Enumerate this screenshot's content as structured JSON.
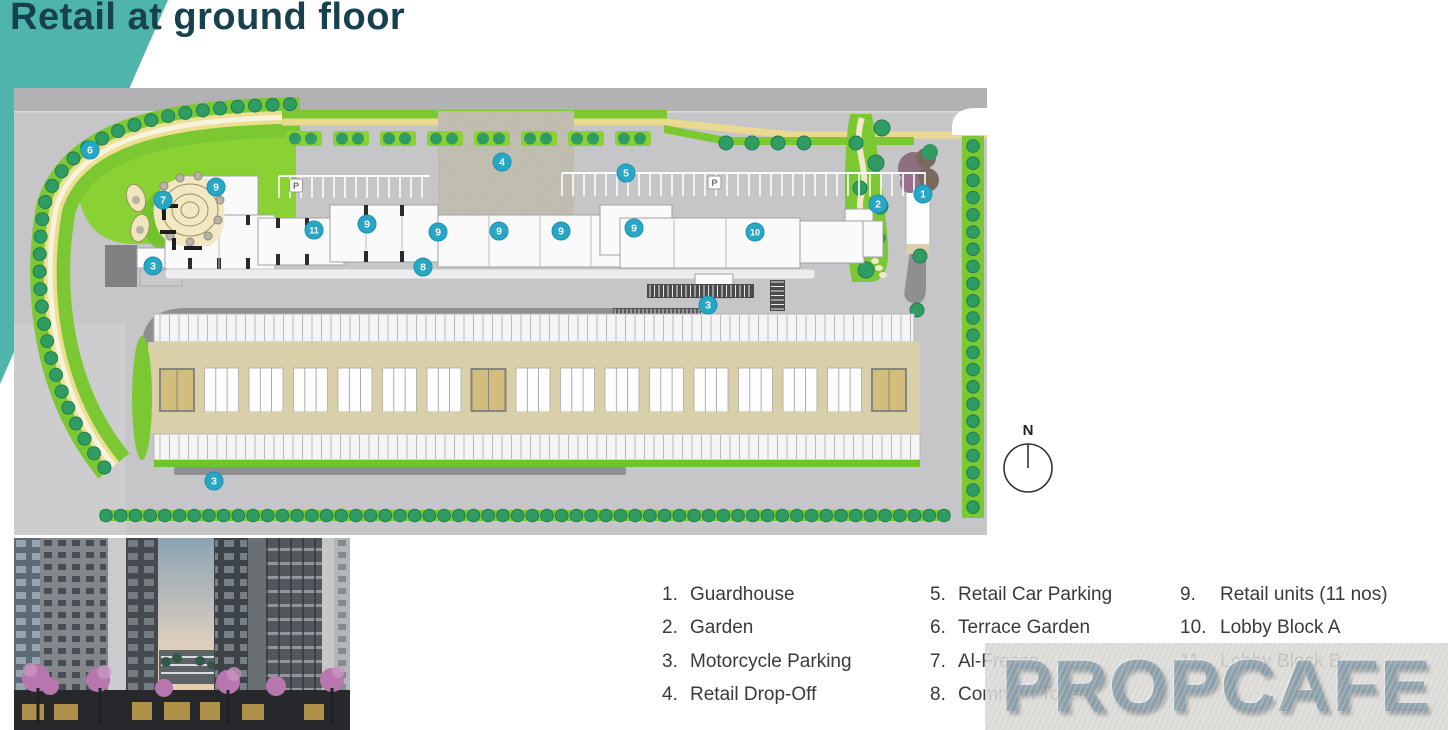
{
  "header": {
    "title": "Retail at ground floor"
  },
  "plan": {
    "compass_label": "N",
    "parking_sign": "P",
    "marker_color": "#29a6c6",
    "markers": [
      {
        "n": "1",
        "x": 909,
        "y": 106
      },
      {
        "n": "2",
        "x": 864,
        "y": 116
      },
      {
        "n": "3",
        "x": 139,
        "y": 178
      },
      {
        "n": "3",
        "x": 694,
        "y": 217
      },
      {
        "n": "3",
        "x": 200,
        "y": 393
      },
      {
        "n": "4",
        "x": 488,
        "y": 74
      },
      {
        "n": "5",
        "x": 612,
        "y": 85
      },
      {
        "n": "6",
        "x": 76,
        "y": 62
      },
      {
        "n": "7",
        "x": 149,
        "y": 112
      },
      {
        "n": "8",
        "x": 409,
        "y": 179
      },
      {
        "n": "9",
        "x": 202,
        "y": 99
      },
      {
        "n": "9",
        "x": 353,
        "y": 136
      },
      {
        "n": "9",
        "x": 424,
        "y": 144
      },
      {
        "n": "9",
        "x": 485,
        "y": 143
      },
      {
        "n": "9",
        "x": 547,
        "y": 143
      },
      {
        "n": "9",
        "x": 620,
        "y": 140
      },
      {
        "n": "10",
        "x": 741,
        "y": 144
      },
      {
        "n": "11",
        "x": 300,
        "y": 142
      }
    ]
  },
  "legend": {
    "items": [
      {
        "num": "1.",
        "label": "Guardhouse"
      },
      {
        "num": "2.",
        "label": "Garden"
      },
      {
        "num": "3.",
        "label": "Motorcycle Parking"
      },
      {
        "num": "4.",
        "label": "Retail Drop-Off"
      },
      {
        "num": "5.",
        "label": "Retail Car Parking"
      },
      {
        "num": "6.",
        "label": "Terrace Garden"
      },
      {
        "num": "7.",
        "label": "Al-Fresco"
      },
      {
        "num": "8.",
        "label": "Common Toilet"
      },
      {
        "num": "9.",
        "label": "Retail units (11 nos)"
      },
      {
        "num": "10.",
        "label": "Lobby Block A"
      },
      {
        "num": "11.",
        "label": "Lobby Block B"
      }
    ]
  },
  "watermark": {
    "text": "PROPCAFE"
  },
  "colors": {
    "accent_teal": "#4fb5ab",
    "title_text": "#17414f",
    "marker_teal": "#29a6c6",
    "lawn_green": "#8ad133",
    "hedge_green": "#7cc832",
    "tree_green": "#2f9c64",
    "road_yellow": "#ecdf92",
    "parking_tan": "#d9cfa9"
  }
}
